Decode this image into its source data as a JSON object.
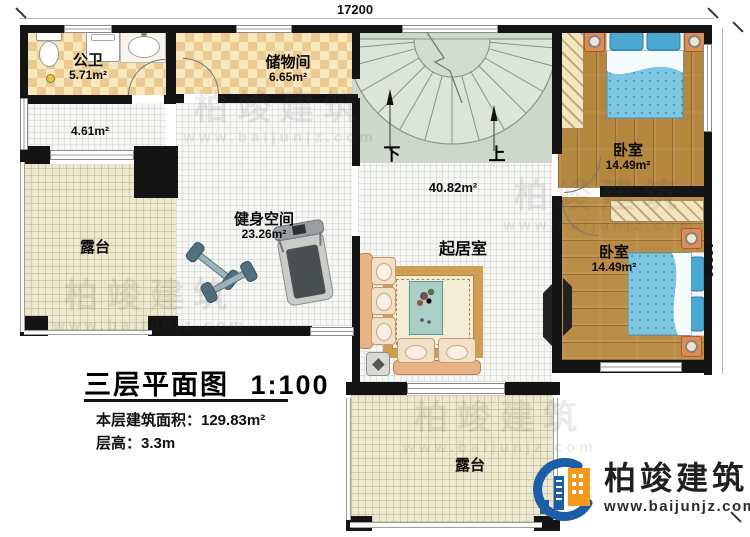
{
  "plan": {
    "dimension_top": "17200",
    "dimension_right": "12300",
    "stair_down": "下",
    "stair_up": "上",
    "rooms": {
      "bathroom": {
        "name": "公卫",
        "area": "5.71m²"
      },
      "storage": {
        "name": "储物间",
        "area": "6.65m²"
      },
      "corridor": {
        "area": "4.61m²"
      },
      "terrace_left": {
        "name": "露台"
      },
      "gym": {
        "name": "健身空间",
        "area": "23.26m²"
      },
      "living": {
        "name": "起居室",
        "area": "40.82m²"
      },
      "bedroom_top": {
        "name": "卧室",
        "area": "14.49m²"
      },
      "bedroom_bottom": {
        "name": "卧室",
        "area": "14.49m²"
      },
      "terrace_bottom": {
        "name": "露台"
      }
    }
  },
  "title_block": {
    "title": "三层平面图",
    "scale": "1:100",
    "area_line": "本层建筑面积：129.83m²",
    "floor_height_line": "层高：3.3m"
  },
  "logo": {
    "company": "柏竣建筑",
    "website": "www.baijunjz.com"
  },
  "watermark": {
    "brand": "柏竣建筑",
    "site": "www.baijunjz.com"
  },
  "colors": {
    "wall": "#141414",
    "tile_dark": "#ecca92",
    "tile_light": "#f8e6bd",
    "wood": "#b5873e",
    "terrace": "#ece7cf",
    "stair_bg": "#cdd7cc",
    "bed_blue": "#7cc6e2",
    "pillow_blue": "#49a9d2",
    "nightstand_orange": "#e08b54",
    "sofa_tan": "#e7b285",
    "logo_blue": "#1b5ea6",
    "logo_orange": "#f5991d"
  }
}
